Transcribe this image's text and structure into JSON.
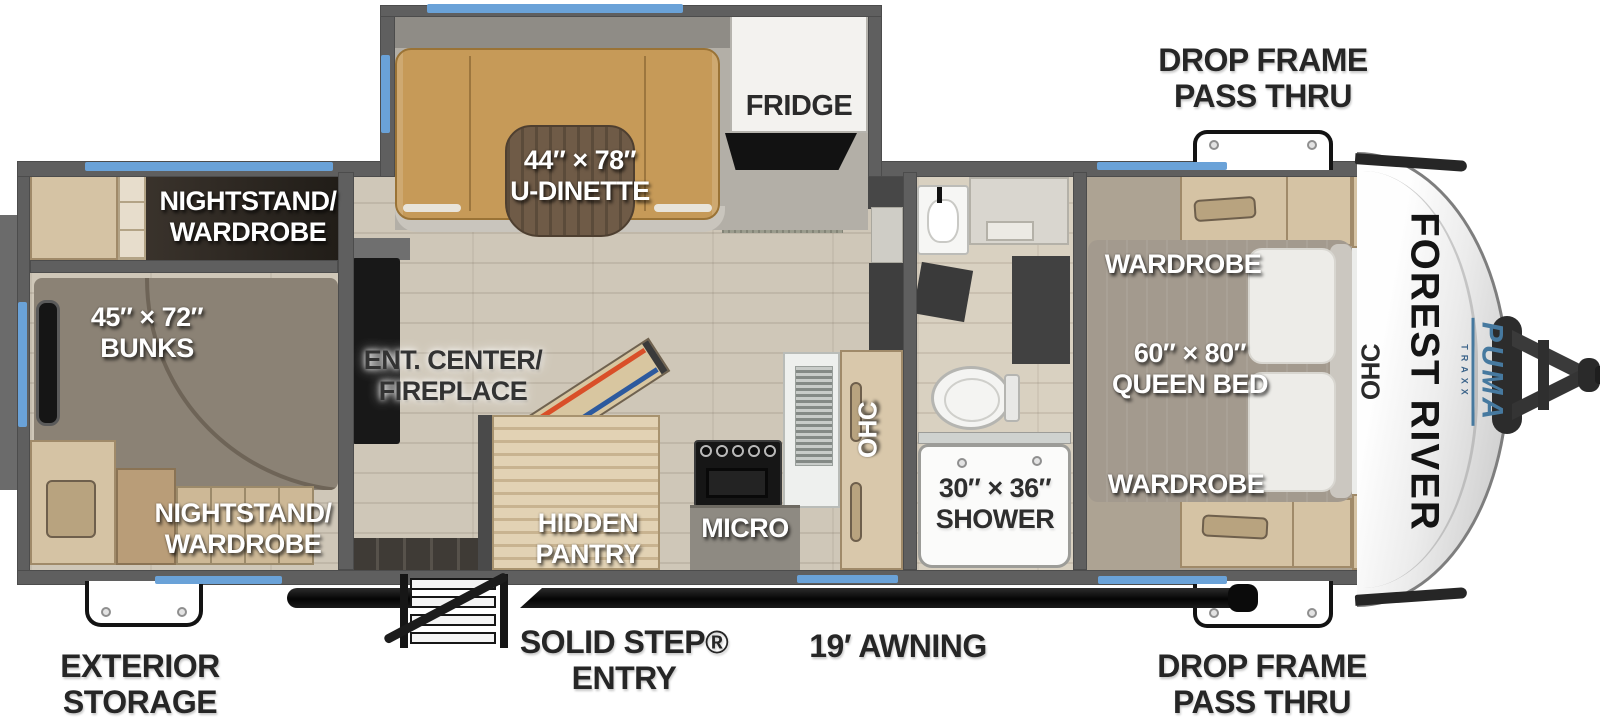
{
  "page": {
    "title": "Forest River Puma Travel Trailer Floor Plan"
  },
  "colors": {
    "window_accent": "#6aa2d8",
    "wall_gray": "#5f5f5f",
    "dinette_tan": "#c69a58",
    "brand_blue": "#46799f",
    "label_white": "#ffffff",
    "label_dark": "#2b2b2b"
  },
  "branding": {
    "manufacturer": "FOREST RIVER",
    "model": "PUMA",
    "model_sub": "TRAXX"
  },
  "exterior_labels": {
    "pass_thru_top": [
      "DROP FRAME",
      "PASS THRU"
    ],
    "pass_thru_bottom": [
      "DROP FRAME",
      "PASS THRU"
    ],
    "exterior_storage": [
      "EXTERIOR",
      "STORAGE"
    ],
    "entry": [
      "SOLID STEP®",
      "ENTRY"
    ],
    "awning": "19′ AWNING"
  },
  "rooms": {
    "bunk_room": {
      "nightstand_top": [
        "NIGHTSTAND/",
        "WARDROBE"
      ],
      "bunks": [
        "45″ × 72″",
        "BUNKS"
      ],
      "nightstand_bottom": [
        "NIGHTSTAND/",
        "WARDROBE"
      ]
    },
    "living_kitchen": {
      "dinette": [
        "44″ × 78″",
        "U-DINETTE"
      ],
      "fridge": "FRIDGE",
      "ent_center": [
        "ENT. CENTER/",
        "FIREPLACE"
      ],
      "hidden_pantry": [
        "HIDDEN",
        "PANTRY"
      ],
      "micro": "MICRO",
      "ohc": "OHC"
    },
    "bathroom": {
      "shower": [
        "30″ × 36″",
        "SHOWER"
      ]
    },
    "bedroom": {
      "wardrobe_top": "WARDROBE",
      "queen_bed": [
        "60″ × 80″",
        "QUEEN BED"
      ],
      "wardrobe_bottom": "WARDROBE",
      "ohc": "OHC"
    }
  }
}
